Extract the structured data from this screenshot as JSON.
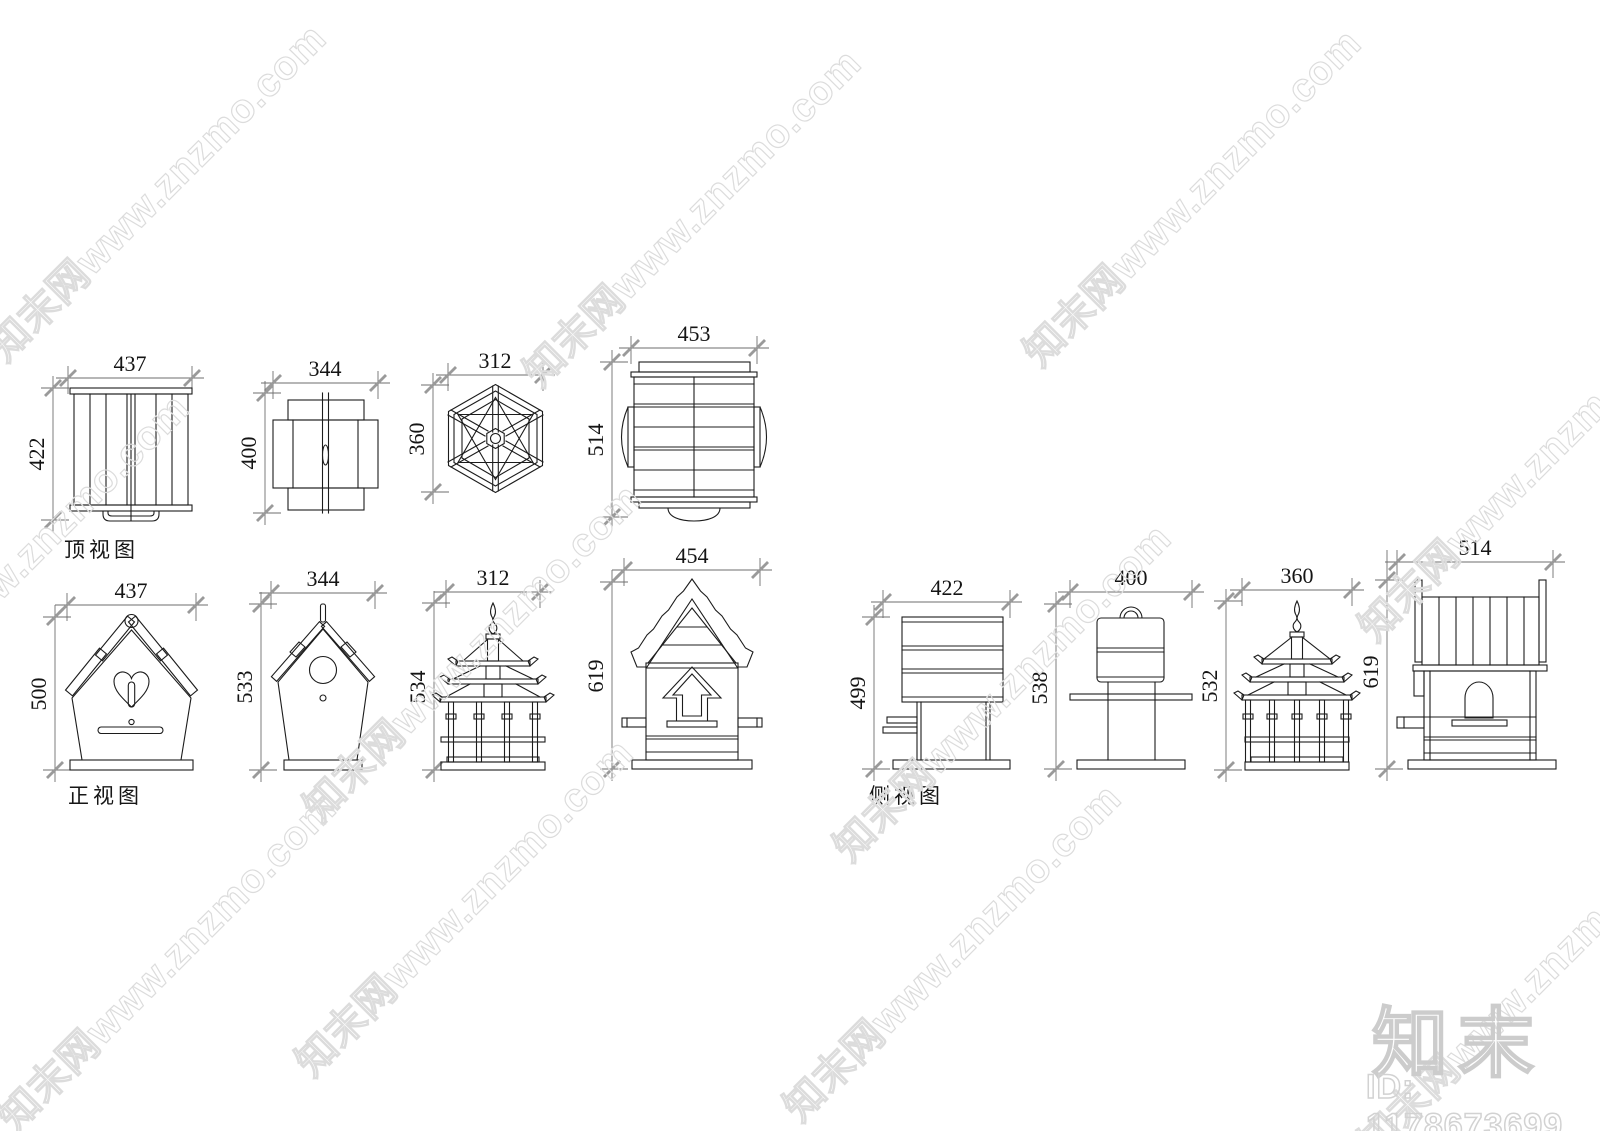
{
  "canvas": {
    "width": 1600,
    "height": 1131,
    "background": "#ffffff"
  },
  "watermark": {
    "text": "知末网www.znzmo.com"
  },
  "brand": {
    "logo_text": "知末",
    "item_id": "ID: 1178673699"
  },
  "views": {
    "top": {
      "label": "顶视图",
      "items": [
        {
          "name": "plank panel birdhouse",
          "width": "437",
          "height": "422"
        },
        {
          "name": "flat-pack birdhouse",
          "width": "344",
          "height": "400"
        },
        {
          "name": "hexagonal gazebo birdhouse",
          "width": "312",
          "height": "360"
        },
        {
          "name": "log cabin bird feeder",
          "width": "453",
          "height": "514"
        }
      ]
    },
    "front": {
      "label": "正视图",
      "items": [
        {
          "name": "heart birdhouse",
          "width": "437",
          "height": "500"
        },
        {
          "name": "classic birdhouse",
          "width": "344",
          "height": "533"
        },
        {
          "name": "pagoda birdhouse",
          "width": "312",
          "height": "534"
        },
        {
          "name": "cabin bird feeder",
          "width": "454",
          "height": "619"
        }
      ]
    },
    "side": {
      "label": "侧视图",
      "items": [
        {
          "name": "plank panel birdhouse",
          "width": "422",
          "height": "499"
        },
        {
          "name": "flat-pack birdhouse",
          "width": "400",
          "height": "538"
        },
        {
          "name": "pagoda birdhouse",
          "width": "360",
          "height": "532"
        },
        {
          "name": "cabin bird feeder",
          "width": "514",
          "height": "619"
        }
      ]
    }
  }
}
